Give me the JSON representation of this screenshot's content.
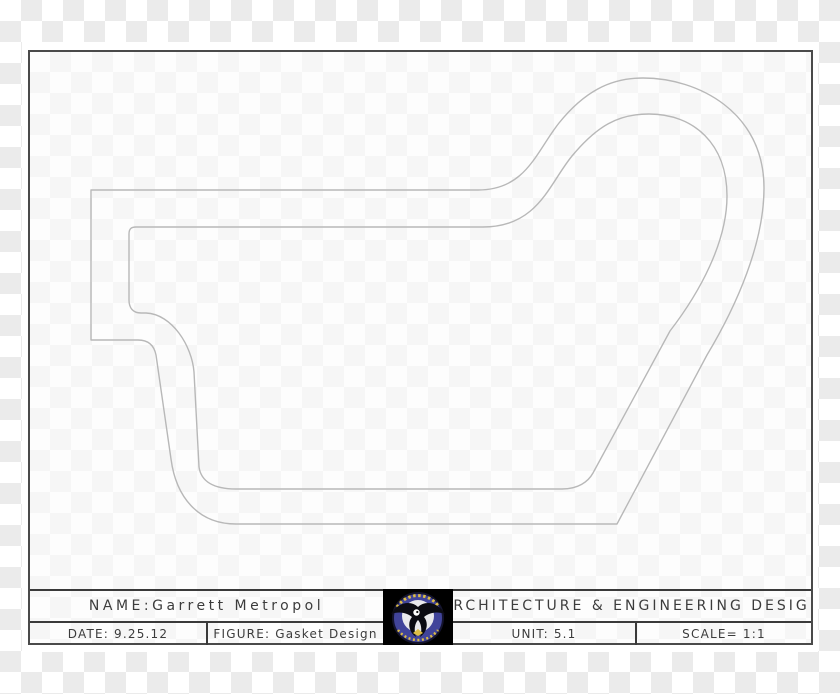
{
  "sheet": {
    "title_block": {
      "name": "NAME:Garrett Metropol",
      "firm": "ARCHITECTURE & ENGINEERING DESIGN",
      "date": "DATE: 9.25.12",
      "figure": "FIGURE: Gasket Design",
      "unit": "UNIT: 5.1",
      "scale": "SCALE= 1:1"
    },
    "logo": {
      "icon": "eagle-emblem-icon",
      "background": "#000000",
      "circle_color": "#41449a",
      "ring_text_color": "#dcbc45"
    },
    "drawing": {
      "line_color": "#b8b8b8",
      "outer_path": "M 91 190 L 478 190 C 526 190 536 152 559 123 C 584 92 610 78 643 78 C 698 78 764 112 764 188 C 764 243 737 305 707 355 L 617 524 L 236 524 C 198 524 176 497 171 459 L 156 355 C 154 345 148 340 138 340 L 91 340 Z",
      "inner_path": "M 136 227 L 483 227 C 538 227 549 184 572 156 C 597 126 618 114 649 114 C 694 114 727 144 727 196 C 727 242 700 292 670 331 L 593 473 C 588 482 578 489 562 489 L 236 489 C 213 489 201 481 199 467 L 194 372 C 192 346 172 314 146 313 L 141 313 C 133 313 129 308 129 300 L 129 234 C 129 229 131 227 136 227 Z"
    }
  },
  "colors": {
    "checker_dark": "#ebebeb",
    "frame": "#4a4a4a",
    "title_text": "#3c3c3c"
  }
}
